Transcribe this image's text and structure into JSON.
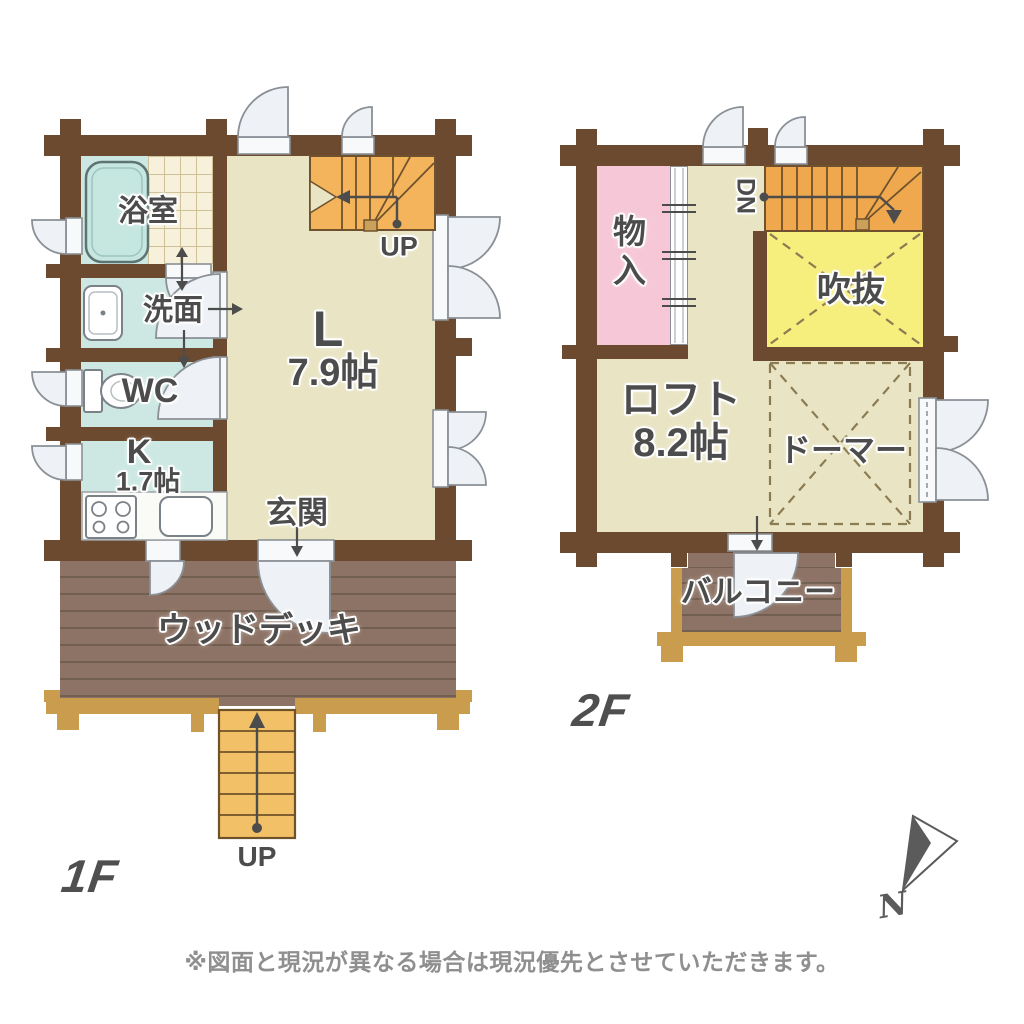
{
  "disclaimer": "※図面と現況が異なる場合は現況優先とさせていただきます。",
  "compass": {
    "north_label": "N"
  },
  "floor1": {
    "title": "1F",
    "rooms": {
      "bathroom": "浴室",
      "washroom": "洗面",
      "toilet": "WC",
      "kitchen_label": "K",
      "kitchen_size": "1.7帖",
      "living_label": "L",
      "living_size": "7.9帖",
      "entrance": "玄関",
      "wood_deck": "ウッドデッキ"
    },
    "stairs_up_label": "UP",
    "entry_steps_label": "UP"
  },
  "floor2": {
    "title": "2F",
    "rooms": {
      "storage": "物入",
      "atrium_void": "吹抜",
      "loft_label": "ロフト",
      "loft_size": "8.2帖",
      "dormer": "ドーマー",
      "balcony": "バルコニー"
    },
    "stairs_down_label": "DN"
  },
  "colors": {
    "wall": "#6b4a2f",
    "floor_main": "#e9e4c3",
    "floor_wet": "#cde8e3",
    "tile": "#f7f0da",
    "stairs_1f": "#f4b45c",
    "stairs_2f": "#f0a84e",
    "entry_steps": "#f2c167",
    "storage_pink": "#f6c7d6",
    "void_yellow": "#f6ee7d",
    "deck_brown": "#8d7365",
    "frame_gold": "#c99c4e",
    "door_white": "#eef2f6",
    "label_gray": "#4c4c4c"
  }
}
